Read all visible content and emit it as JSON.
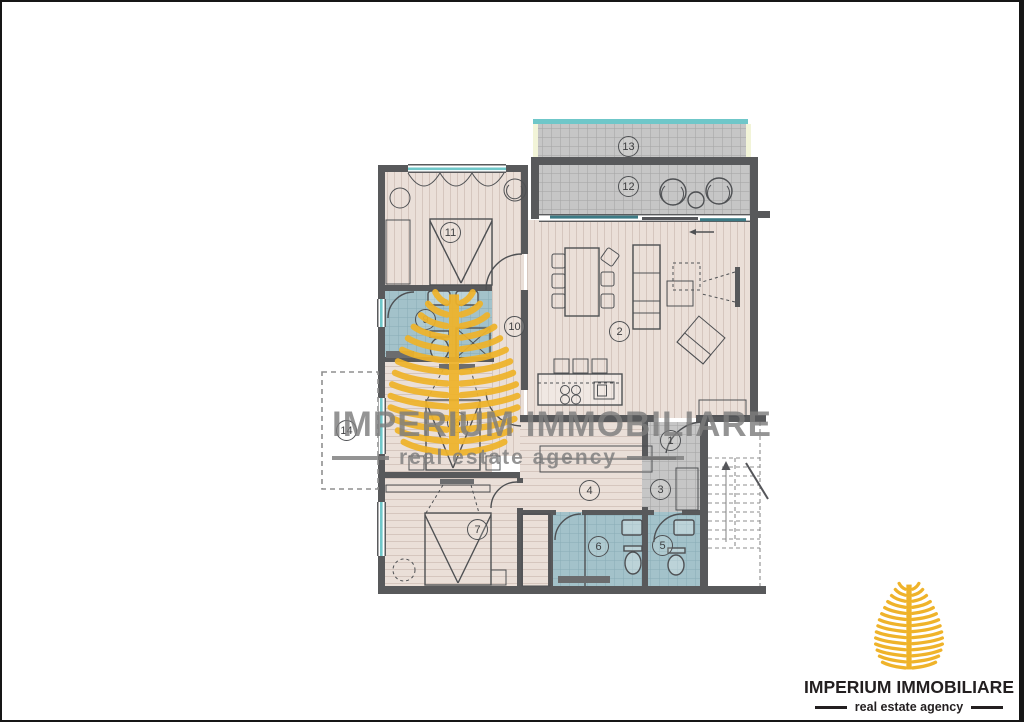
{
  "watermark": {
    "title": "IMPERIUM IMMOBILIARE",
    "subtitle": "real estate agency"
  },
  "logo": {
    "title": "IMPERIUM IMMOBILIARE",
    "subtitle": "real estate agency"
  },
  "floor_plan": {
    "room_labels": [
      {
        "number": "1",
        "x": 669,
        "y": 439
      },
      {
        "number": "2",
        "x": 618,
        "y": 330
      },
      {
        "number": "3",
        "x": 659,
        "y": 488
      },
      {
        "number": "4",
        "x": 588,
        "y": 489
      },
      {
        "number": "5",
        "x": 661,
        "y": 544
      },
      {
        "number": "6",
        "x": 597,
        "y": 545
      },
      {
        "number": "7",
        "x": 476,
        "y": 528
      },
      {
        "number": "8",
        "x": 456,
        "y": 421
      },
      {
        "number": "9",
        "x": 424,
        "y": 318
      },
      {
        "number": "10",
        "x": 513,
        "y": 325
      },
      {
        "number": "11",
        "x": 449,
        "y": 231
      },
      {
        "number": "12",
        "x": 627,
        "y": 185
      },
      {
        "number": "13",
        "x": 627,
        "y": 145
      },
      {
        "number": "14",
        "x": 345,
        "y": 429
      }
    ]
  },
  "colors": {
    "wall": "#58595b",
    "wood_floor": "#eadfd8",
    "wood_stripe": "#d5c6be",
    "tile_floor": "#a3c2ca",
    "tile_grid": "#88acb6",
    "terrace_floor": "#bdbdbd",
    "terrace_grid": "#a3a3a3",
    "terrace_border": "#f2f4d8",
    "window_teal": "#6fc7c9",
    "gold": "#efb32a",
    "logo_text": "#231f20",
    "watermark_text": "#7d7d7d"
  }
}
